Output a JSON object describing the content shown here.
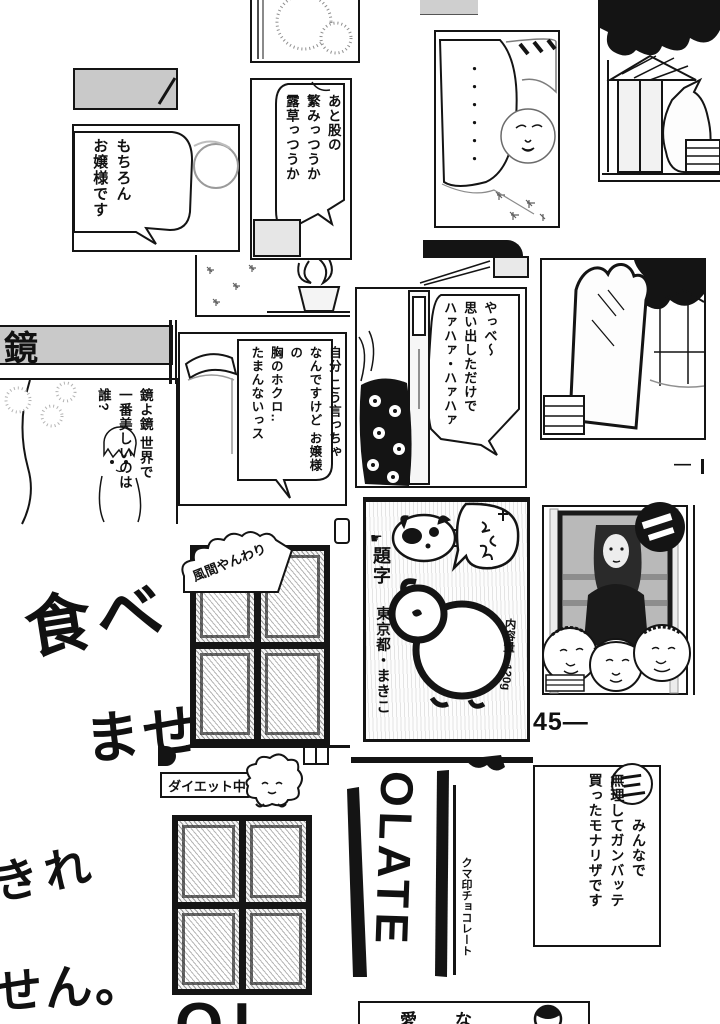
{
  "colors": {
    "ink": "#141414",
    "gray_bar": "#c9c9c9",
    "halftone": "#bfbfbf"
  },
  "panels": {
    "maid": {
      "speech": "もちろん\nお嬢様です"
    },
    "undergrowth": {
      "speech": "あと股の\n繁みっつうか\n露草っつうか"
    },
    "silence": {
      "dots": "・・・・・・"
    },
    "mirror_sign": {
      "label": "鏡"
    },
    "mirror_question": {
      "speech": "鏡よ鏡 世界で\n一番美しいのは\n誰?"
    },
    "mole_confession": {
      "speech": "自分 こう言っちゃ\nなんですけど お嬢様の\n胸のホクロ‥\nたまんないっス"
    },
    "flashback": {
      "speech": "やっべ〜\n思い出しただけで\nハァハァ・ハァハァ"
    },
    "mona_lisa_caption": {
      "panel_number": "三",
      "speech": "　　　みんなで\n無理してガンバッテ\n買ったモナリザです"
    }
  },
  "handwriting": {
    "fragment_tabe": "食べ",
    "fragment_mase": "ませ",
    "fragment_kire": "きれ",
    "fragment_sen": "せん。"
  },
  "chocolate": {
    "artist_credit": "風間やんわり",
    "diet_note": "ダイエット中",
    "wrapper_letters": "OLATE",
    "wrapper_brand": "クマ印チョコレート",
    "net_weight": "内容量・120g",
    "bottom_letters_fragment": "OL",
    "bottom_panel_fragment": "愛な"
  },
  "credits": {
    "title_lettering_label": "題字",
    "title_lettering_credit": "東京都・まきこ",
    "pointer_icon": "☛"
  },
  "page": {
    "number": "45―",
    "edge_mark": "―"
  }
}
